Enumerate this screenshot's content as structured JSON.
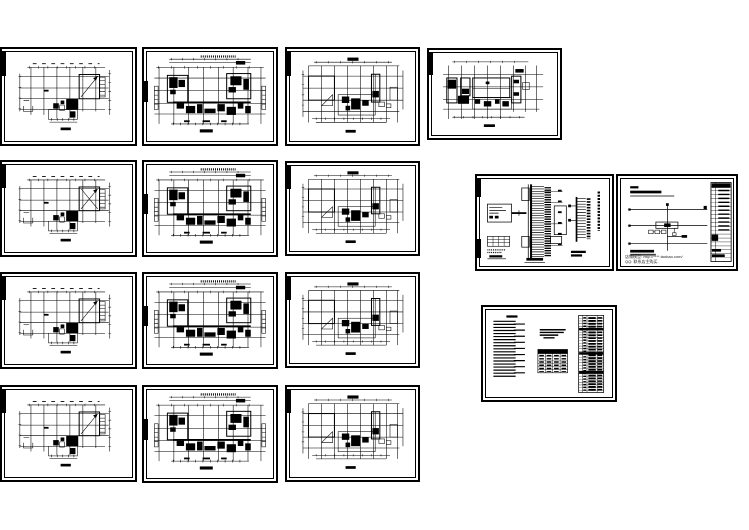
{
  "page": {
    "background_color": "#ffffff",
    "ink_color": "#000000",
    "description": "Thumbnail montage of a Chinese CAD electrical drawing set: 13 floor-plan sheets in 4 rows, one two-panel power distribution system diagram sheet, and one design-notes/legend sheet"
  },
  "collection": {
    "rows": 4,
    "sheet_count": 16,
    "kinds": [
      "floor-plan",
      "system-diagram",
      "notes-sheet"
    ]
  },
  "sheets": [
    {
      "id": "floor-plan-r1c1",
      "kind": "floor-plan",
      "variant": "A",
      "x": 0,
      "y": 47,
      "w": 137,
      "h": 99,
      "bar": "top"
    },
    {
      "id": "floor-plan-r1c2",
      "kind": "floor-plan",
      "variant": "B",
      "x": 142,
      "y": 47,
      "w": 136,
      "h": 99,
      "bar": "mid"
    },
    {
      "id": "floor-plan-r1c3",
      "kind": "floor-plan",
      "variant": "C",
      "x": 285,
      "y": 47,
      "w": 135,
      "h": 99,
      "bar": "top"
    },
    {
      "id": "floor-plan-r1c4",
      "kind": "floor-plan",
      "variant": "D",
      "x": 427,
      "y": 48,
      "w": 135,
      "h": 92,
      "bar": "top"
    },
    {
      "id": "floor-plan-r2c1",
      "kind": "floor-plan",
      "variant": "AX",
      "x": 0,
      "y": 160,
      "w": 137,
      "h": 97,
      "bar": "top"
    },
    {
      "id": "floor-plan-r2c2",
      "kind": "floor-plan",
      "variant": "B",
      "x": 142,
      "y": 160,
      "w": 136,
      "h": 97,
      "bar": "mid"
    },
    {
      "id": "floor-plan-r2c3",
      "kind": "floor-plan",
      "variant": "C",
      "x": 285,
      "y": 161,
      "w": 135,
      "h": 95,
      "bar": "top"
    },
    {
      "id": "system-riser-diagram",
      "kind": "system-diagram",
      "variant": "RISER",
      "x": 475,
      "y": 174,
      "w": 139,
      "h": 97,
      "bar": "both"
    },
    {
      "id": "system-distribution-diagram",
      "kind": "system-diagram",
      "variant": "SYSTEM",
      "x": 616,
      "y": 174,
      "w": 122,
      "h": 97,
      "bar": "none",
      "watermark": true
    },
    {
      "id": "floor-plan-r3c1",
      "kind": "floor-plan",
      "variant": "A",
      "x": 0,
      "y": 272,
      "w": 137,
      "h": 97,
      "bar": "top"
    },
    {
      "id": "floor-plan-r3c2",
      "kind": "floor-plan",
      "variant": "B",
      "x": 142,
      "y": 272,
      "w": 136,
      "h": 97,
      "bar": "mid"
    },
    {
      "id": "floor-plan-r3c3",
      "kind": "floor-plan",
      "variant": "C",
      "x": 285,
      "y": 272,
      "w": 135,
      "h": 96,
      "bar": "top"
    },
    {
      "id": "design-notes-legend",
      "kind": "notes-sheet",
      "variant": "NOTES",
      "x": 481,
      "y": 305,
      "w": 136,
      "h": 97,
      "bar": "none"
    },
    {
      "id": "floor-plan-r4c1",
      "kind": "floor-plan",
      "variant": "A",
      "x": 0,
      "y": 385,
      "w": 137,
      "h": 97,
      "bar": "top"
    },
    {
      "id": "floor-plan-r4c2",
      "kind": "floor-plan",
      "variant": "B",
      "x": 142,
      "y": 385,
      "w": 136,
      "h": 98,
      "bar": "mid"
    },
    {
      "id": "floor-plan-r4c3",
      "kind": "floor-plan",
      "variant": "C",
      "x": 285,
      "y": 385,
      "w": 135,
      "h": 97,
      "bar": "top"
    }
  ],
  "watermark": {
    "line1": "店铺模型: http://****.taobao.com/",
    "line2": "QQ: 联系店主购买."
  }
}
